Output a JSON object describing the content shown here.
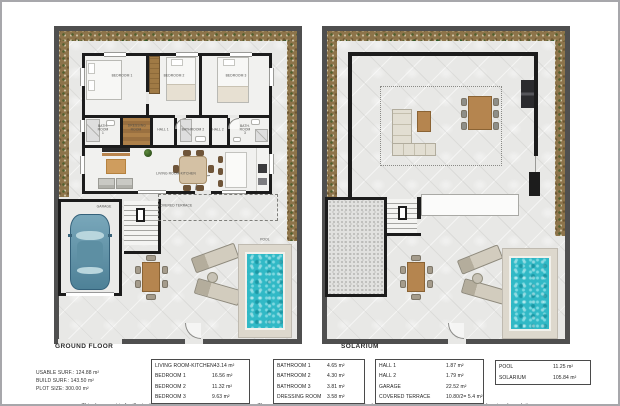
{
  "ground_floor": {
    "title": "GROUND FLOOR",
    "labels": {
      "bedroom1": "BEDROOM 1",
      "bedroom2": "BEDROOM 2",
      "bedroom3": "BEDROOM 3",
      "bathroom1": "BATH. ROOM 1",
      "dressing_room": "DRESSING ROOM",
      "hall1": "HALL 1",
      "bathroom2": "BATHROOM 2",
      "hall2": "HALL 2",
      "bathroom3": "BATH. ROOM 3",
      "living_room": "LIVING ROOM-KITCHEN",
      "garage": "GARAGE",
      "covered_terrace": "COVERED TERRACE",
      "pool": "POOL"
    }
  },
  "solarium": {
    "title": "SOLARIUM"
  },
  "stats": {
    "usable": "USABLE SURF.: 124.88 m²",
    "build": "BUILD SURF.: 143.50 m²",
    "plot": "PLOT SIZE: 300.00 m²"
  },
  "tables": [
    {
      "rows": [
        {
          "label": "LIVING ROOM-KITCHEN",
          "value": "43.14 m²"
        },
        {
          "label": "BEDROOM 1",
          "value": "16.56 m²"
        },
        {
          "label": "BEDROOM 2",
          "value": "11.32 m²"
        },
        {
          "label": "BEDROOM 3",
          "value": "9.63 m²"
        }
      ]
    },
    {
      "rows": [
        {
          "label": "BATHROOM 1",
          "value": "4.65 m²"
        },
        {
          "label": "BATHROOM 2",
          "value": "4.30 m²"
        },
        {
          "label": "BATHROOM 3",
          "value": "3.81 m²"
        },
        {
          "label": "DRESSING ROOM",
          "value": "3.58 m²"
        }
      ]
    },
    {
      "rows": [
        {
          "label": "HALL 1",
          "value": "1.87 m²"
        },
        {
          "label": "HALL 2",
          "value": "1.79 m²"
        },
        {
          "label": "GARAGE",
          "value": "22.52 m²"
        },
        {
          "label": "COVERED TERRACE",
          "value": "10.80/2= 5.4 m²"
        }
      ]
    },
    {
      "rows": [
        {
          "label": "POOL",
          "value": "11.25 m²"
        },
        {
          "label": "SOLARIUM",
          "value": "105.84 m²"
        }
      ]
    }
  ],
  "disclaimer": "This document is for illustrative purposes only and is not legally binding. The values are subject to change based on technical considerations, construction updates and regional regulations.",
  "colors": {
    "wall": "#1c1c1c",
    "fence": "#4f4f4f",
    "pool_water": "#31b9c6",
    "garden": "#8d744a",
    "wood": "#b5854f",
    "car": "#4e8197"
  }
}
